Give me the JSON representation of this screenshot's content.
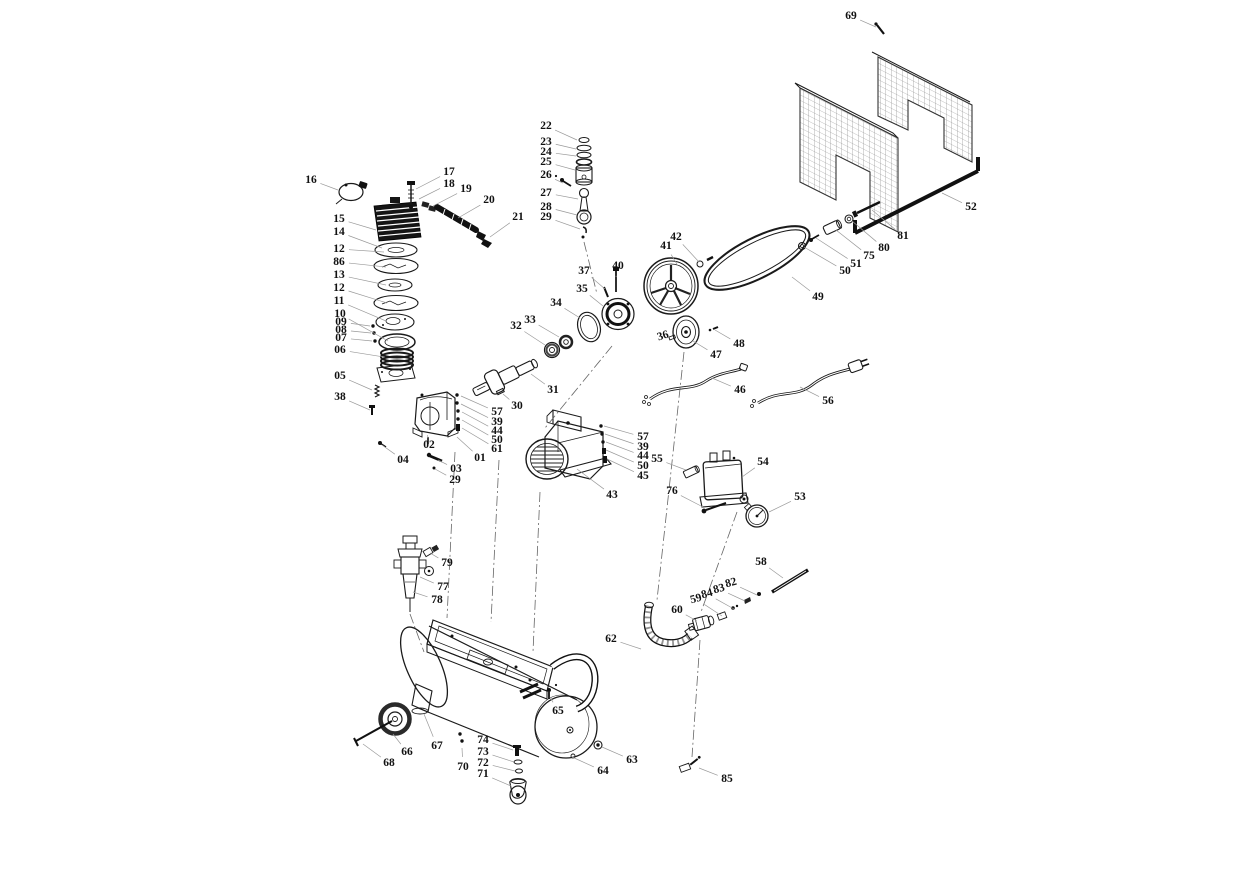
{
  "figure": {
    "type": "exploded-parts-diagram",
    "subject": "belt-drive air compressor exploded view",
    "colors": {
      "background": "#ffffff",
      "ink": "#1a1a1a",
      "leader": "#9a9a9a",
      "label": "#111111"
    },
    "parts": [
      {
        "label": "16",
        "x": 311,
        "y": 180,
        "tx": 338,
        "ty": 190
      },
      {
        "label": "15",
        "x": 339,
        "y": 219,
        "tx": 376,
        "ty": 230
      },
      {
        "label": "14",
        "x": 339,
        "y": 232,
        "tx": 382,
        "ty": 248
      },
      {
        "label": "12",
        "x": 339,
        "y": 249,
        "tx": 384,
        "ty": 252
      },
      {
        "label": "86",
        "x": 339,
        "y": 262,
        "tx": 386,
        "ty": 267
      },
      {
        "label": "13",
        "x": 339,
        "y": 275,
        "tx": 386,
        "ty": 285
      },
      {
        "label": "12",
        "x": 339,
        "y": 288,
        "tx": 387,
        "ty": 303
      },
      {
        "label": "11",
        "x": 339,
        "y": 301,
        "tx": 386,
        "ty": 321
      },
      {
        "label": "10",
        "x": 340,
        "y": 314,
        "tx": 388,
        "ty": 341
      },
      {
        "label": "09",
        "x": 341,
        "y": 322,
        "tx": 370,
        "ty": 326,
        "size": 10
      },
      {
        "label": "08",
        "x": 341,
        "y": 330,
        "tx": 371,
        "ty": 333,
        "size": 10
      },
      {
        "label": "07",
        "x": 341,
        "y": 338,
        "tx": 372,
        "ty": 341,
        "size": 10
      },
      {
        "label": "06",
        "x": 340,
        "y": 350,
        "tx": 384,
        "ty": 357
      },
      {
        "label": "05",
        "x": 340,
        "y": 376,
        "tx": 372,
        "ty": 390
      },
      {
        "label": "38",
        "x": 340,
        "y": 397,
        "tx": 370,
        "ty": 410
      },
      {
        "label": "17",
        "x": 449,
        "y": 172,
        "tx": 416,
        "ty": 189
      },
      {
        "label": "18",
        "x": 449,
        "y": 184,
        "tx": 419,
        "ty": 199
      },
      {
        "label": "19",
        "x": 466,
        "y": 189,
        "tx": 433,
        "ty": 206
      },
      {
        "label": "20",
        "x": 489,
        "y": 200,
        "tx": 458,
        "ty": 218
      },
      {
        "label": "21",
        "x": 518,
        "y": 217,
        "tx": 490,
        "ty": 237
      },
      {
        "label": "22",
        "x": 546,
        "y": 126,
        "tx": 577,
        "ty": 140
      },
      {
        "label": "23",
        "x": 546,
        "y": 142,
        "tx": 576,
        "ty": 149
      },
      {
        "label": "24",
        "x": 546,
        "y": 152,
        "tx": 576,
        "ty": 156
      },
      {
        "label": "25",
        "x": 546,
        "y": 162,
        "tx": 575,
        "ty": 170
      },
      {
        "label": "26",
        "x": 546,
        "y": 175,
        "tx": 563,
        "ty": 183
      },
      {
        "label": "27",
        "x": 546,
        "y": 193,
        "tx": 578,
        "ty": 199
      },
      {
        "label": "28",
        "x": 546,
        "y": 207,
        "tx": 577,
        "ty": 215
      },
      {
        "label": "29",
        "x": 546,
        "y": 217,
        "tx": 580,
        "ty": 229
      },
      {
        "label": "69",
        "x": 851,
        "y": 16,
        "tx": 876,
        "ty": 27
      },
      {
        "label": "52",
        "x": 971,
        "y": 207,
        "tx": 942,
        "ty": 193
      },
      {
        "label": "81",
        "x": 903,
        "y": 236,
        "tx": 872,
        "ty": 210
      },
      {
        "label": "80",
        "x": 884,
        "y": 248,
        "tx": 852,
        "ty": 221
      },
      {
        "label": "75",
        "x": 869,
        "y": 256,
        "tx": 836,
        "ty": 230
      },
      {
        "label": "51",
        "x": 856,
        "y": 264,
        "tx": 816,
        "ty": 238
      },
      {
        "label": "50",
        "x": 845,
        "y": 271,
        "tx": 804,
        "ty": 247
      },
      {
        "label": "42",
        "x": 676,
        "y": 237,
        "tx": 699,
        "ty": 262
      },
      {
        "label": "41",
        "x": 666,
        "y": 246,
        "tx": 678,
        "ty": 266
      },
      {
        "label": "49",
        "x": 818,
        "y": 297,
        "tx": 792,
        "ty": 277
      },
      {
        "label": "48",
        "x": 739,
        "y": 344,
        "tx": 715,
        "ty": 330
      },
      {
        "label": "47",
        "x": 716,
        "y": 355,
        "tx": 693,
        "ty": 341
      },
      {
        "label": "36",
        "x": 663,
        "y": 336,
        "tx": 672,
        "ty": 339,
        "rot": -18,
        "size": 8.5
      },
      {
        "label": "46",
        "x": 740,
        "y": 390,
        "tx": 712,
        "ty": 378
      },
      {
        "label": "56",
        "x": 828,
        "y": 401,
        "tx": 800,
        "ty": 387
      },
      {
        "label": "37",
        "x": 584,
        "y": 271,
        "tx": 605,
        "ty": 289
      },
      {
        "label": "35",
        "x": 582,
        "y": 289,
        "tx": 603,
        "ty": 306
      },
      {
        "label": "40",
        "x": 618,
        "y": 266,
        "tx": 616,
        "ty": 277
      },
      {
        "label": "34",
        "x": 556,
        "y": 303,
        "tx": 580,
        "ty": 318
      },
      {
        "label": "33",
        "x": 530,
        "y": 320,
        "tx": 559,
        "ty": 337
      },
      {
        "label": "32",
        "x": 516,
        "y": 326,
        "tx": 545,
        "ty": 345
      },
      {
        "label": "31",
        "x": 553,
        "y": 390,
        "tx": 531,
        "ty": 374
      },
      {
        "label": "30",
        "x": 517,
        "y": 406,
        "tx": 503,
        "ty": 394
      },
      {
        "label": "57",
        "x": 497,
        "y": 412,
        "tx": 461,
        "ty": 396
      },
      {
        "label": "39",
        "x": 497,
        "y": 422,
        "tx": 461,
        "ty": 404
      },
      {
        "label": "44",
        "x": 497,
        "y": 431,
        "tx": 462,
        "ty": 412
      },
      {
        "label": "50",
        "x": 497,
        "y": 440,
        "tx": 462,
        "ty": 420
      },
      {
        "label": "61",
        "x": 497,
        "y": 449,
        "tx": 462,
        "ty": 428
      },
      {
        "label": "01",
        "x": 480,
        "y": 458,
        "tx": 457,
        "ty": 437
      },
      {
        "label": "02",
        "x": 429,
        "y": 445,
        "tx": 428,
        "ty": 438
      },
      {
        "label": "04",
        "x": 403,
        "y": 460,
        "tx": 382,
        "ty": 445
      },
      {
        "label": "03",
        "x": 456,
        "y": 469,
        "tx": 438,
        "ty": 460
      },
      {
        "label": "29",
        "x": 455,
        "y": 480,
        "tx": 435,
        "ty": 469
      },
      {
        "label": "43",
        "x": 612,
        "y": 495,
        "tx": 577,
        "ty": 469
      },
      {
        "label": "57",
        "x": 643,
        "y": 437,
        "tx": 604,
        "ty": 426
      },
      {
        "label": "39",
        "x": 643,
        "y": 447,
        "tx": 605,
        "ty": 434
      },
      {
        "label": "44",
        "x": 643,
        "y": 456,
        "tx": 606,
        "ty": 442
      },
      {
        "label": "50",
        "x": 643,
        "y": 466,
        "tx": 606,
        "ty": 450
      },
      {
        "label": "45",
        "x": 643,
        "y": 476,
        "tx": 607,
        "ty": 459
      },
      {
        "label": "55",
        "x": 657,
        "y": 459,
        "tx": 686,
        "ty": 470
      },
      {
        "label": "54",
        "x": 763,
        "y": 462,
        "tx": 742,
        "ty": 477
      },
      {
        "label": "76",
        "x": 672,
        "y": 491,
        "tx": 703,
        "ty": 507
      },
      {
        "label": "53",
        "x": 800,
        "y": 497,
        "tx": 769,
        "ty": 512
      },
      {
        "label": "58",
        "x": 761,
        "y": 562,
        "tx": 783,
        "ty": 578
      },
      {
        "label": "82",
        "x": 731,
        "y": 583,
        "tx": 757,
        "ty": 595,
        "rot": -15,
        "size": 9.5
      },
      {
        "label": "83",
        "x": 719,
        "y": 589,
        "tx": 745,
        "ty": 601,
        "rot": -15,
        "size": 9.5
      },
      {
        "label": "84",
        "x": 707,
        "y": 594,
        "tx": 734,
        "ty": 609,
        "rot": -15,
        "size": 9.5
      },
      {
        "label": "59",
        "x": 696,
        "y": 599,
        "tx": 722,
        "ty": 616,
        "rot": -15,
        "size": 9.5
      },
      {
        "label": "60",
        "x": 677,
        "y": 610,
        "tx": 697,
        "ty": 621
      },
      {
        "label": "62",
        "x": 611,
        "y": 639,
        "tx": 641,
        "ty": 649
      },
      {
        "label": "65",
        "x": 558,
        "y": 711,
        "tx": 550,
        "ty": 697
      },
      {
        "label": "63",
        "x": 632,
        "y": 760,
        "tx": 602,
        "ty": 747
      },
      {
        "label": "64",
        "x": 603,
        "y": 771,
        "tx": 572,
        "ty": 757
      },
      {
        "label": "85",
        "x": 727,
        "y": 779,
        "tx": 699,
        "ty": 768
      },
      {
        "label": "79",
        "x": 447,
        "y": 563,
        "tx": 430,
        "ty": 553
      },
      {
        "label": "77",
        "x": 443,
        "y": 587,
        "tx": 420,
        "ty": 577
      },
      {
        "label": "78",
        "x": 437,
        "y": 600,
        "tx": 413,
        "ty": 592
      },
      {
        "label": "66",
        "x": 407,
        "y": 752,
        "tx": 393,
        "ty": 734
      },
      {
        "label": "67",
        "x": 437,
        "y": 746,
        "tx": 424,
        "ty": 714
      },
      {
        "label": "68",
        "x": 389,
        "y": 763,
        "tx": 363,
        "ty": 744
      },
      {
        "label": "70",
        "x": 463,
        "y": 767,
        "tx": 462,
        "ty": 748
      },
      {
        "label": "74",
        "x": 483,
        "y": 740,
        "tx": 513,
        "ty": 750
      },
      {
        "label": "73",
        "x": 483,
        "y": 752,
        "tx": 514,
        "ty": 762
      },
      {
        "label": "72",
        "x": 483,
        "y": 763,
        "tx": 515,
        "ty": 771
      },
      {
        "label": "71",
        "x": 483,
        "y": 774,
        "tx": 511,
        "ty": 786
      }
    ]
  }
}
